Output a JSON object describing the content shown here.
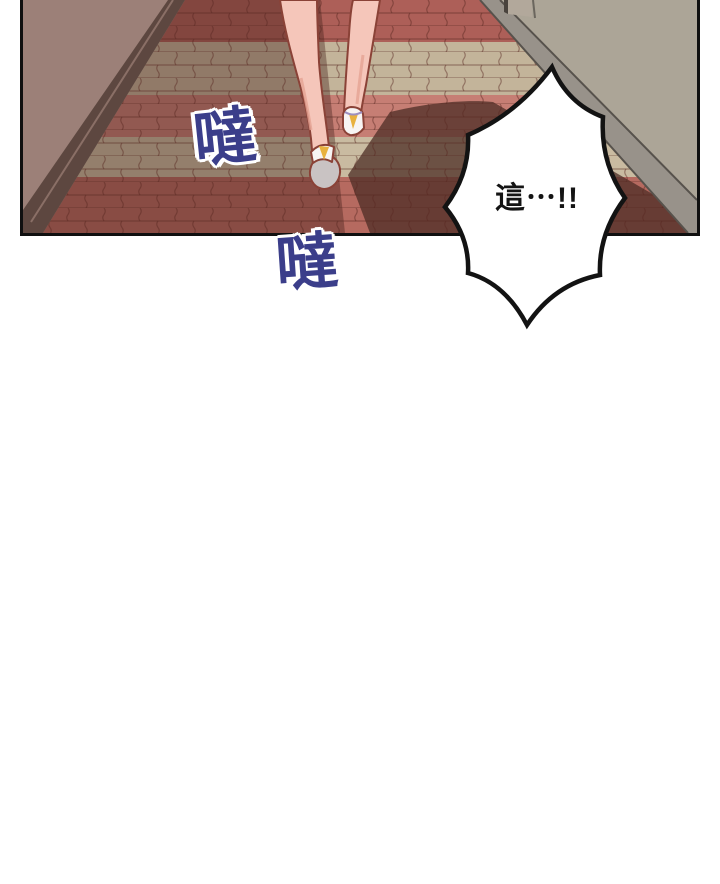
{
  "panel": {
    "border_color": "#101010",
    "scene": {
      "left_wall": "#9c8078",
      "left_baseboard": "#5d4740",
      "left_baseboard_highlight": "#8a6f66",
      "right_wall": "#aca597",
      "right_baseboard": "#98928a",
      "right_baseboard_edge": "#57524c",
      "door": "#b2a89b",
      "door_frame": "#49433d",
      "floor_base": "#9a8578",
      "bands": {
        "red": "#ad5f58",
        "tan": "#c3b49a",
        "pink": "#c67e74",
        "tan2": "#c9bba1",
        "red2": "#b66a60"
      },
      "mortar": "rgba(86,38,32,0.45)",
      "ambient_shadow": "rgba(62,28,24,0.38)",
      "cast_shadow": "rgba(76,46,38,0.75)",
      "skin": "#f5c6ba",
      "skin_outline": "#8a4237",
      "skin_shade": "#e5a294",
      "shoe_white": "#f7f4f3",
      "shoe_sole": "#c9c3c3",
      "shoe_accent": "#e8b13e",
      "shoe_strap": "#9c8fc0"
    }
  },
  "speech_bubble": {
    "text": "這⋯!!",
    "fill": "#ffffff",
    "stroke": "#131313",
    "text_color": "#141414"
  },
  "sfx": {
    "first": "噠",
    "second": "噠",
    "color": "#3b3e8a",
    "halo": "#ffffff"
  }
}
